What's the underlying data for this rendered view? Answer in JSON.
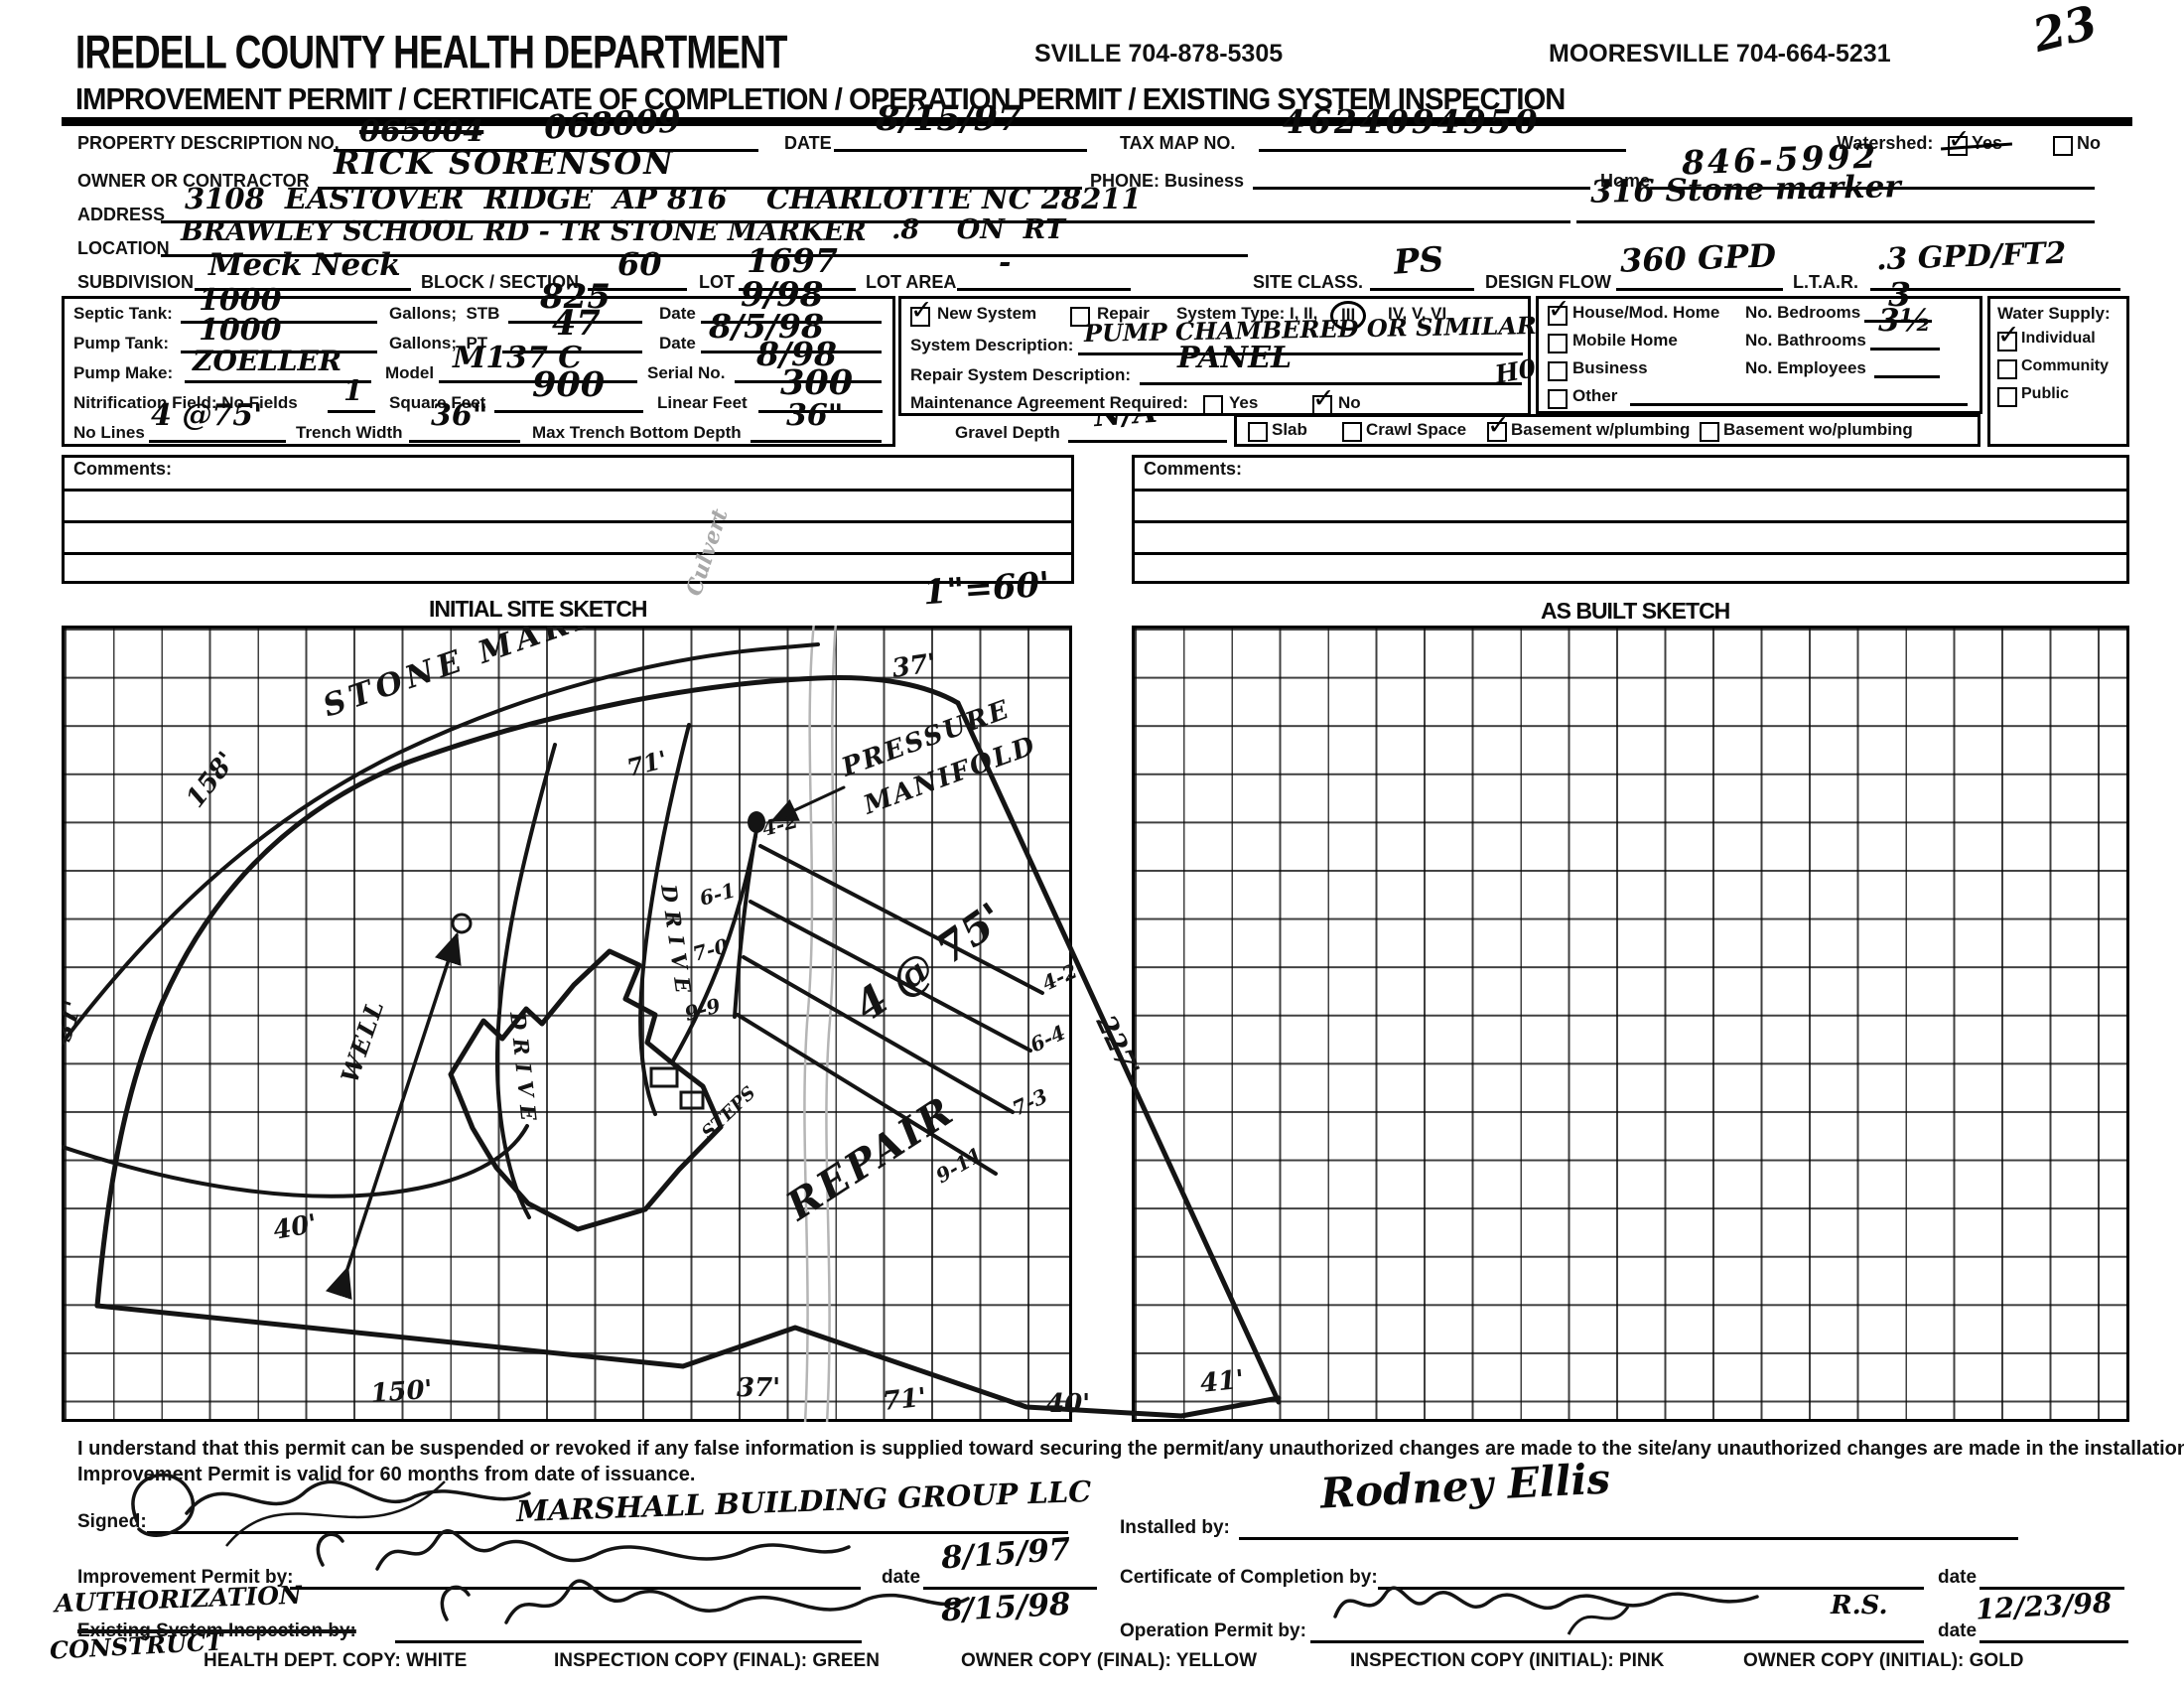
{
  "header": {
    "agency": "IREDELL COUNTY HEALTH DEPARTMENT",
    "phone_statesville": "SVILLE 704-878-5305",
    "phone_mooresville": "MOORESVILLE 704-664-5231",
    "page_scribble": "23",
    "form_title": "IMPROVEMENT PERMIT / CERTIFICATE OF COMPLETION / OPERATION PERMIT / EXISTING SYSTEM INSPECTION"
  },
  "fields": {
    "property_label": "PROPERTY DESCRIPTION NO.",
    "property_no_struck": "065004",
    "property_no": "068009",
    "date_label": "DATE",
    "date": "8/15/97",
    "tax_map_label": "TAX MAP NO.",
    "tax_map": "4624094950",
    "watershed_label": "Watershed:",
    "watershed_yes": "Yes",
    "watershed_no": "No",
    "owner_label": "OWNER OR CONTRACTOR",
    "owner": "RICK SORENSON",
    "phone_label": "PHONE: Business",
    "home_label": "Home",
    "home_phone": "846-5992",
    "address_label": "ADDRESS",
    "address": "3108  EASTOVER  RIDGE  AP 816",
    "address_city": "CHARLOTTE NC 28211",
    "address_right": "316 Stone marker",
    "location_label": "LOCATION",
    "location": "BRAWLEY SCHOOL RD - TR STONE MARKER",
    "location2": ".8    ON  RT",
    "subdivision_label": "SUBDIVISION",
    "subdivision": "Meck Neck",
    "block_label": "BLOCK / SECTION",
    "block": "60",
    "lot_label": "LOT",
    "lot": "1697",
    "lot_area_label": "LOT AREA",
    "lot_area": "-",
    "site_class_label": "SITE CLASS.",
    "site_class": "PS",
    "design_flow_label": "DESIGN FLOW",
    "design_flow": "360 GPD",
    "ltar_label": "L.T.A.R.",
    "ltar": ".3 GPD/FT2"
  },
  "septic": {
    "septic_tank_label": "Septic Tank:",
    "septic_tank": "1000",
    "gallons_stb_label": "Gallons;  STB",
    "stb": "825",
    "date1_label": "Date",
    "date1": "9/98",
    "pump_tank_label": "Pump Tank:",
    "pump_tank": "1000",
    "gallons_pt_label": "Gallons;  PT",
    "pt": "47",
    "date2_label": "Date",
    "date2": "8/5/98",
    "pump_make_label": "Pump Make:",
    "pump_make": "ZOELLER",
    "model_label": "Model",
    "model": "M137 C",
    "serial_label": "Serial No.",
    "serial": "8/98",
    "nitrification_label": "Nitrification Field: No Fields",
    "fields_count": "1",
    "sqft_label": "Square Feet",
    "sqft": "900",
    "linear_label": "Linear Feet",
    "linear": "300",
    "no_lines_label": "No Lines",
    "no_lines": "4 @75'",
    "trench_width_label": "Trench Width",
    "trench_width": "36\"",
    "max_depth_label": "Max Trench Bottom Depth",
    "max_depth": "36\""
  },
  "system": {
    "new_system": "New System",
    "repair": "Repair",
    "type_prefix": "System Type: I, II,",
    "type_circled": "III",
    "type_suffix": "IV, V, VI",
    "description_label": "System Description:",
    "description": "PUMP CHAMBERED OR SIMILAR",
    "margin_note": "H03",
    "repair_desc_label": "Repair System Description:",
    "repair_desc": "PANEL",
    "maintenance_label": "Maintenance Agreement Required:",
    "yes": "Yes",
    "no": "No"
  },
  "construction": {
    "slab": "Slab",
    "crawl": "Crawl Space",
    "basement_w": "Basement w/plumbing",
    "basement_wo": "Basement wo/plumbing"
  },
  "gravel": {
    "label": "Gravel Depth",
    "value": "N/A"
  },
  "dwelling": {
    "house": "House/Mod. Home",
    "mobile": "Mobile Home",
    "business": "Business",
    "other": "Other",
    "bedrooms_label": "No. Bedrooms",
    "bedrooms": "3",
    "bathrooms_label": "No. Bathrooms",
    "bathrooms": "3½",
    "employees_label": "No. Employees"
  },
  "water": {
    "title": "Water Supply:",
    "individual": "Individual",
    "community": "Community",
    "public": "Public"
  },
  "comments": {
    "label": "Comments:"
  },
  "sketch": {
    "initial_title": "INITIAL SITE SKETCH",
    "as_built_title": "AS BUILT SKETCH",
    "scale": "1\"=60'",
    "culvert": "Culvert",
    "road": "STONE MARKER RD",
    "well": "WELL",
    "drive1": "DRIVE",
    "drive2": "DRIVE",
    "steps": "STEPS",
    "pressure_line1": "PRESSURE",
    "pressure_line2": "MANIFOLD",
    "laterals_note": "4 @ 75'",
    "repair": "REPAIR",
    "dims": {
      "top37": "37'",
      "road71": "71'",
      "left158": "158'",
      "left31": "31'",
      "well40": "40'",
      "bottom150": "150'",
      "bottom37": "37'",
      "bottom71": "71'",
      "bottom40": "40'",
      "bottom41": "41'",
      "right227": "227'"
    },
    "lat_left": [
      "4-2",
      "6-1",
      "7-0",
      "9-9"
    ],
    "lat_right": [
      "4-2",
      "6-4",
      "7-3",
      "9-11"
    ]
  },
  "statement": {
    "line1": "I understand that this permit can be suspended or revoked if any false information is supplied toward securing the permit/any unauthorized changes are made to the site/any unauthorized changes are made in the installation of the system.",
    "line2": "Improvement Permit is valid for 60 months from date of issuance."
  },
  "signatures": {
    "signed_label": "Signed:",
    "signed_company": "MARSHALL BUILDING GROUP LLC",
    "improvement_label": "Improvement Permit by:",
    "improvement_date": "8/15/97",
    "authorization_note": "AUTHORIZATION",
    "construct_note": "CONSTRUCT",
    "existing_label": "Existing System Inspection by:",
    "existing_date": "8/15/98",
    "date_label": "date",
    "installed_label": "Installed by:",
    "installed_by": "Rodney Ellis",
    "certificate_label": "Certificate of Completion by:",
    "operation_label": "Operation Permit by:",
    "operation_suffix": "R.S.",
    "operation_date": "12/23/98"
  },
  "footer": {
    "health": "HEALTH DEPT. COPY: WHITE",
    "inspection_final": "INSPECTION COPY (FINAL): GREEN",
    "owner_final": "OWNER COPY (FINAL): YELLOW",
    "inspection_initial": "INSPECTION COPY (INITIAL): PINK",
    "owner_initial": "OWNER COPY (INITIAL): GOLD"
  },
  "icons": {
    "check": "✓"
  }
}
